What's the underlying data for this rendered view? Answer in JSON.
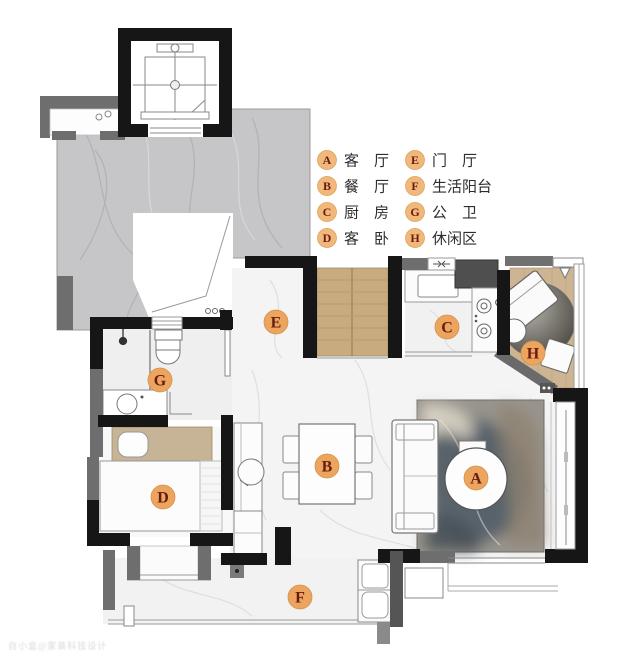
{
  "legend": {
    "items": [
      {
        "letter": "A",
        "label": "客　厅"
      },
      {
        "letter": "B",
        "label": "餐　厅"
      },
      {
        "letter": "C",
        "label": "厨　房"
      },
      {
        "letter": "D",
        "label": "客　卧"
      },
      {
        "letter": "E",
        "label": "门　厅"
      },
      {
        "letter": "F",
        "label": "生活阳台"
      },
      {
        "letter": "G",
        "label": "公　卫"
      },
      {
        "letter": "H",
        "label": "休闲区"
      }
    ]
  },
  "rooms": [
    {
      "letter": "A",
      "name": "客厅"
    },
    {
      "letter": "B",
      "name": "餐厅"
    },
    {
      "letter": "C",
      "name": "厨房"
    },
    {
      "letter": "D",
      "name": "客卧"
    },
    {
      "letter": "E",
      "name": "门厅"
    },
    {
      "letter": "F",
      "name": "生活阳台"
    },
    {
      "letter": "G",
      "name": "公卫"
    },
    {
      "letter": "H",
      "name": "休闲区"
    }
  ],
  "watermark": {
    "text": "自小盒@家装科技设计"
  },
  "colors": {
    "wall_black": "#161616",
    "wall_gray": "#6e6e6e",
    "corridor_marble": "#c6c6c9",
    "interior_floor": "#f4f4f5",
    "wood": "#c8ab7e",
    "marker_fill": "#eba55f",
    "marker_text": "#6b1a10",
    "legend_circle": "#f0b87a"
  }
}
